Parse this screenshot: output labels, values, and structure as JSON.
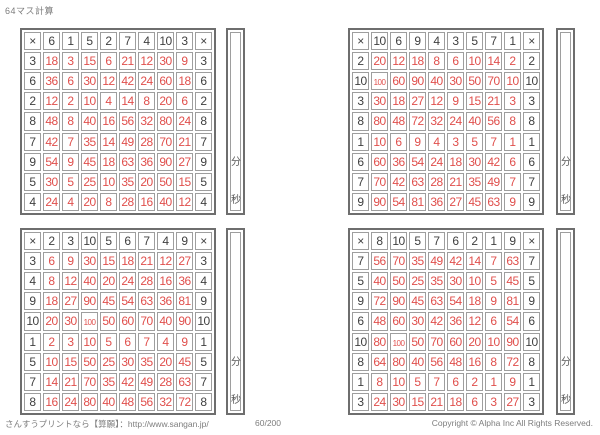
{
  "title": "64マス計算",
  "timer": {
    "minutes": "分",
    "seconds": "秒"
  },
  "footer": {
    "left": "さんすうプリントなら【算願】：http://www.sangan.jp/",
    "page": "60/200",
    "copyright": "Copyright © Alpha Inc All Rights Reserved."
  },
  "colors": {
    "answer_red": "#e04f4c",
    "digit_dark": "#3f3f3f",
    "grid_line": "#9e9e9e",
    "grid_border": "#6e6e6e"
  },
  "grids": [
    {
      "position": "top-left",
      "top_header": [
        "×",
        "6",
        "1",
        "5",
        "2",
        "7",
        "4",
        "10",
        "3",
        "×"
      ],
      "rows": [
        {
          "multiplier": "3",
          "products": [
            "18",
            "3",
            "15",
            "6",
            "21",
            "12",
            "30",
            "9"
          ]
        },
        {
          "multiplier": "6",
          "products": [
            "36",
            "6",
            "30",
            "12",
            "42",
            "24",
            "60",
            "18"
          ]
        },
        {
          "multiplier": "2",
          "products": [
            "12",
            "2",
            "10",
            "4",
            "14",
            "8",
            "20",
            "6"
          ]
        },
        {
          "multiplier": "8",
          "products": [
            "48",
            "8",
            "40",
            "16",
            "56",
            "32",
            "80",
            "24"
          ]
        },
        {
          "multiplier": "7",
          "products": [
            "42",
            "7",
            "35",
            "14",
            "49",
            "28",
            "70",
            "21"
          ]
        },
        {
          "multiplier": "9",
          "products": [
            "54",
            "9",
            "45",
            "18",
            "63",
            "36",
            "90",
            "27"
          ]
        },
        {
          "multiplier": "5",
          "products": [
            "30",
            "5",
            "25",
            "10",
            "35",
            "20",
            "50",
            "15"
          ]
        },
        {
          "multiplier": "4",
          "products": [
            "24",
            "4",
            "20",
            "8",
            "28",
            "16",
            "40",
            "12"
          ]
        }
      ]
    },
    {
      "position": "top-right",
      "top_header": [
        "×",
        "10",
        "6",
        "9",
        "4",
        "3",
        "5",
        "7",
        "1",
        "×"
      ],
      "rows": [
        {
          "multiplier": "2",
          "products": [
            "20",
            "12",
            "18",
            "8",
            "6",
            "10",
            "14",
            "2"
          ]
        },
        {
          "multiplier": "10",
          "products": [
            "100",
            "60",
            "90",
            "40",
            "30",
            "50",
            "70",
            "10"
          ]
        },
        {
          "multiplier": "3",
          "products": [
            "30",
            "18",
            "27",
            "12",
            "9",
            "15",
            "21",
            "3"
          ]
        },
        {
          "multiplier": "8",
          "products": [
            "80",
            "48",
            "72",
            "32",
            "24",
            "40",
            "56",
            "8"
          ]
        },
        {
          "multiplier": "1",
          "products": [
            "10",
            "6",
            "9",
            "4",
            "3",
            "5",
            "7",
            "1"
          ]
        },
        {
          "multiplier": "6",
          "products": [
            "60",
            "36",
            "54",
            "24",
            "18",
            "30",
            "42",
            "6"
          ]
        },
        {
          "multiplier": "7",
          "products": [
            "70",
            "42",
            "63",
            "28",
            "21",
            "35",
            "49",
            "7"
          ]
        },
        {
          "multiplier": "9",
          "products": [
            "90",
            "54",
            "81",
            "36",
            "27",
            "45",
            "63",
            "9"
          ]
        }
      ]
    },
    {
      "position": "bottom-left",
      "top_header": [
        "×",
        "2",
        "3",
        "10",
        "5",
        "6",
        "7",
        "4",
        "9",
        "×"
      ],
      "rows": [
        {
          "multiplier": "3",
          "products": [
            "6",
            "9",
            "30",
            "15",
            "18",
            "21",
            "12",
            "27"
          ]
        },
        {
          "multiplier": "4",
          "products": [
            "8",
            "12",
            "40",
            "20",
            "24",
            "28",
            "16",
            "36"
          ]
        },
        {
          "multiplier": "9",
          "products": [
            "18",
            "27",
            "90",
            "45",
            "54",
            "63",
            "36",
            "81"
          ]
        },
        {
          "multiplier": "10",
          "products": [
            "20",
            "30",
            "100",
            "50",
            "60",
            "70",
            "40",
            "90"
          ]
        },
        {
          "multiplier": "1",
          "products": [
            "2",
            "3",
            "10",
            "5",
            "6",
            "7",
            "4",
            "9"
          ]
        },
        {
          "multiplier": "5",
          "products": [
            "10",
            "15",
            "50",
            "25",
            "30",
            "35",
            "20",
            "45"
          ]
        },
        {
          "multiplier": "7",
          "products": [
            "14",
            "21",
            "70",
            "35",
            "42",
            "49",
            "28",
            "63"
          ]
        },
        {
          "multiplier": "8",
          "products": [
            "16",
            "24",
            "80",
            "40",
            "48",
            "56",
            "32",
            "72"
          ]
        }
      ]
    },
    {
      "position": "bottom-right",
      "top_header": [
        "×",
        "8",
        "10",
        "5",
        "7",
        "6",
        "2",
        "1",
        "9",
        "×"
      ],
      "rows": [
        {
          "multiplier": "7",
          "products": [
            "56",
            "70",
            "35",
            "49",
            "42",
            "14",
            "7",
            "63"
          ]
        },
        {
          "multiplier": "5",
          "products": [
            "40",
            "50",
            "25",
            "35",
            "30",
            "10",
            "5",
            "45"
          ]
        },
        {
          "multiplier": "9",
          "products": [
            "72",
            "90",
            "45",
            "63",
            "54",
            "18",
            "9",
            "81"
          ]
        },
        {
          "multiplier": "6",
          "products": [
            "48",
            "60",
            "30",
            "42",
            "36",
            "12",
            "6",
            "54"
          ]
        },
        {
          "multiplier": "10",
          "products": [
            "80",
            "100",
            "50",
            "70",
            "60",
            "20",
            "10",
            "90"
          ]
        },
        {
          "multiplier": "8",
          "products": [
            "64",
            "80",
            "40",
            "56",
            "48",
            "16",
            "8",
            "72"
          ]
        },
        {
          "multiplier": "1",
          "products": [
            "8",
            "10",
            "5",
            "7",
            "6",
            "2",
            "1",
            "9"
          ]
        },
        {
          "multiplier": "3",
          "products": [
            "24",
            "30",
            "15",
            "21",
            "18",
            "6",
            "3",
            "27"
          ]
        }
      ]
    }
  ]
}
